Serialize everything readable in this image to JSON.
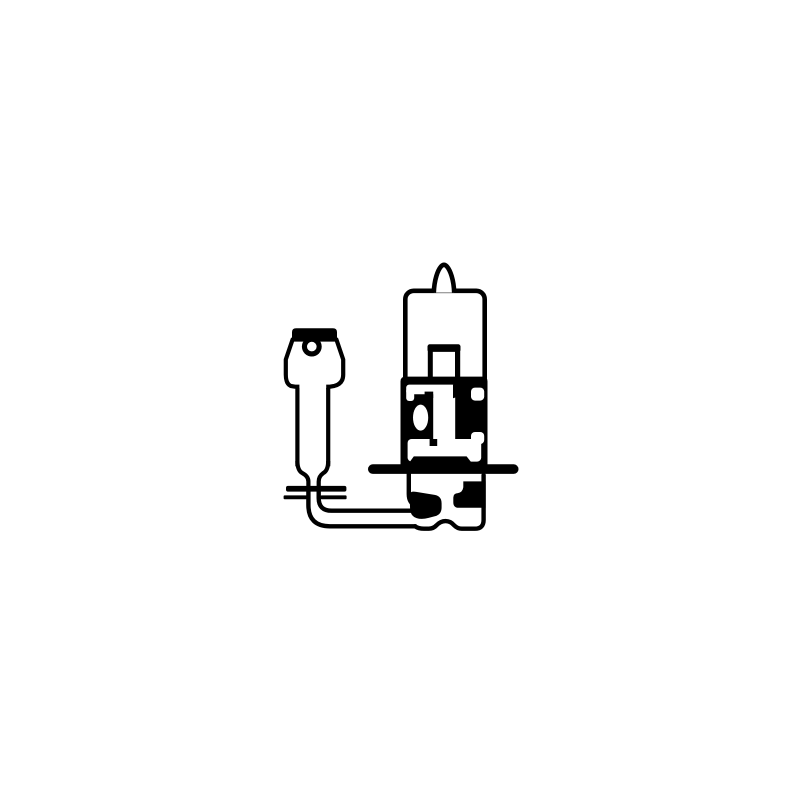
{
  "canvas": {
    "width": 800,
    "height": 800
  },
  "colors": {
    "ink": "#000000",
    "paper": "#ffffff"
  },
  "illustration": {
    "label": "Black line drawing of an H3 halogen automotive bulb: rounded glass envelope with pointed sealed tip, metal base with wide horizontal mounting flange, lower contact skirt, and a lead wire curving 90 degrees to a flat spade terminal with a locating hole",
    "subject": "H3 halogen bulb with spade connector",
    "parts": [
      {
        "name": "bulb-tip",
        "description": "Pointed sealed tip on top of the glass envelope"
      },
      {
        "name": "bulb-envelope",
        "description": "Rounded rectangular glass envelope outline"
      },
      {
        "name": "filament-shield",
        "description": "Inner filament mount tube drawn inside the envelope"
      },
      {
        "name": "base-upper",
        "description": "Upper metal base block with white cutout detailing and oval window"
      },
      {
        "name": "mounting-flange",
        "description": "Wide horizontal mounting flange bar with rounded ends"
      },
      {
        "name": "flange-bump",
        "description": "Trapezoid boss sitting on top of the flange"
      },
      {
        "name": "base-lower",
        "description": "Lower base skirt with wavy bottom edge and black contact pads"
      },
      {
        "name": "lead-wire",
        "description": "Lead wire curving from the spade terminal into the lower base"
      },
      {
        "name": "spade-terminal",
        "description": "Flat spade connector with hole, insulator sleeve, shaft and entry grommet"
      }
    ]
  }
}
